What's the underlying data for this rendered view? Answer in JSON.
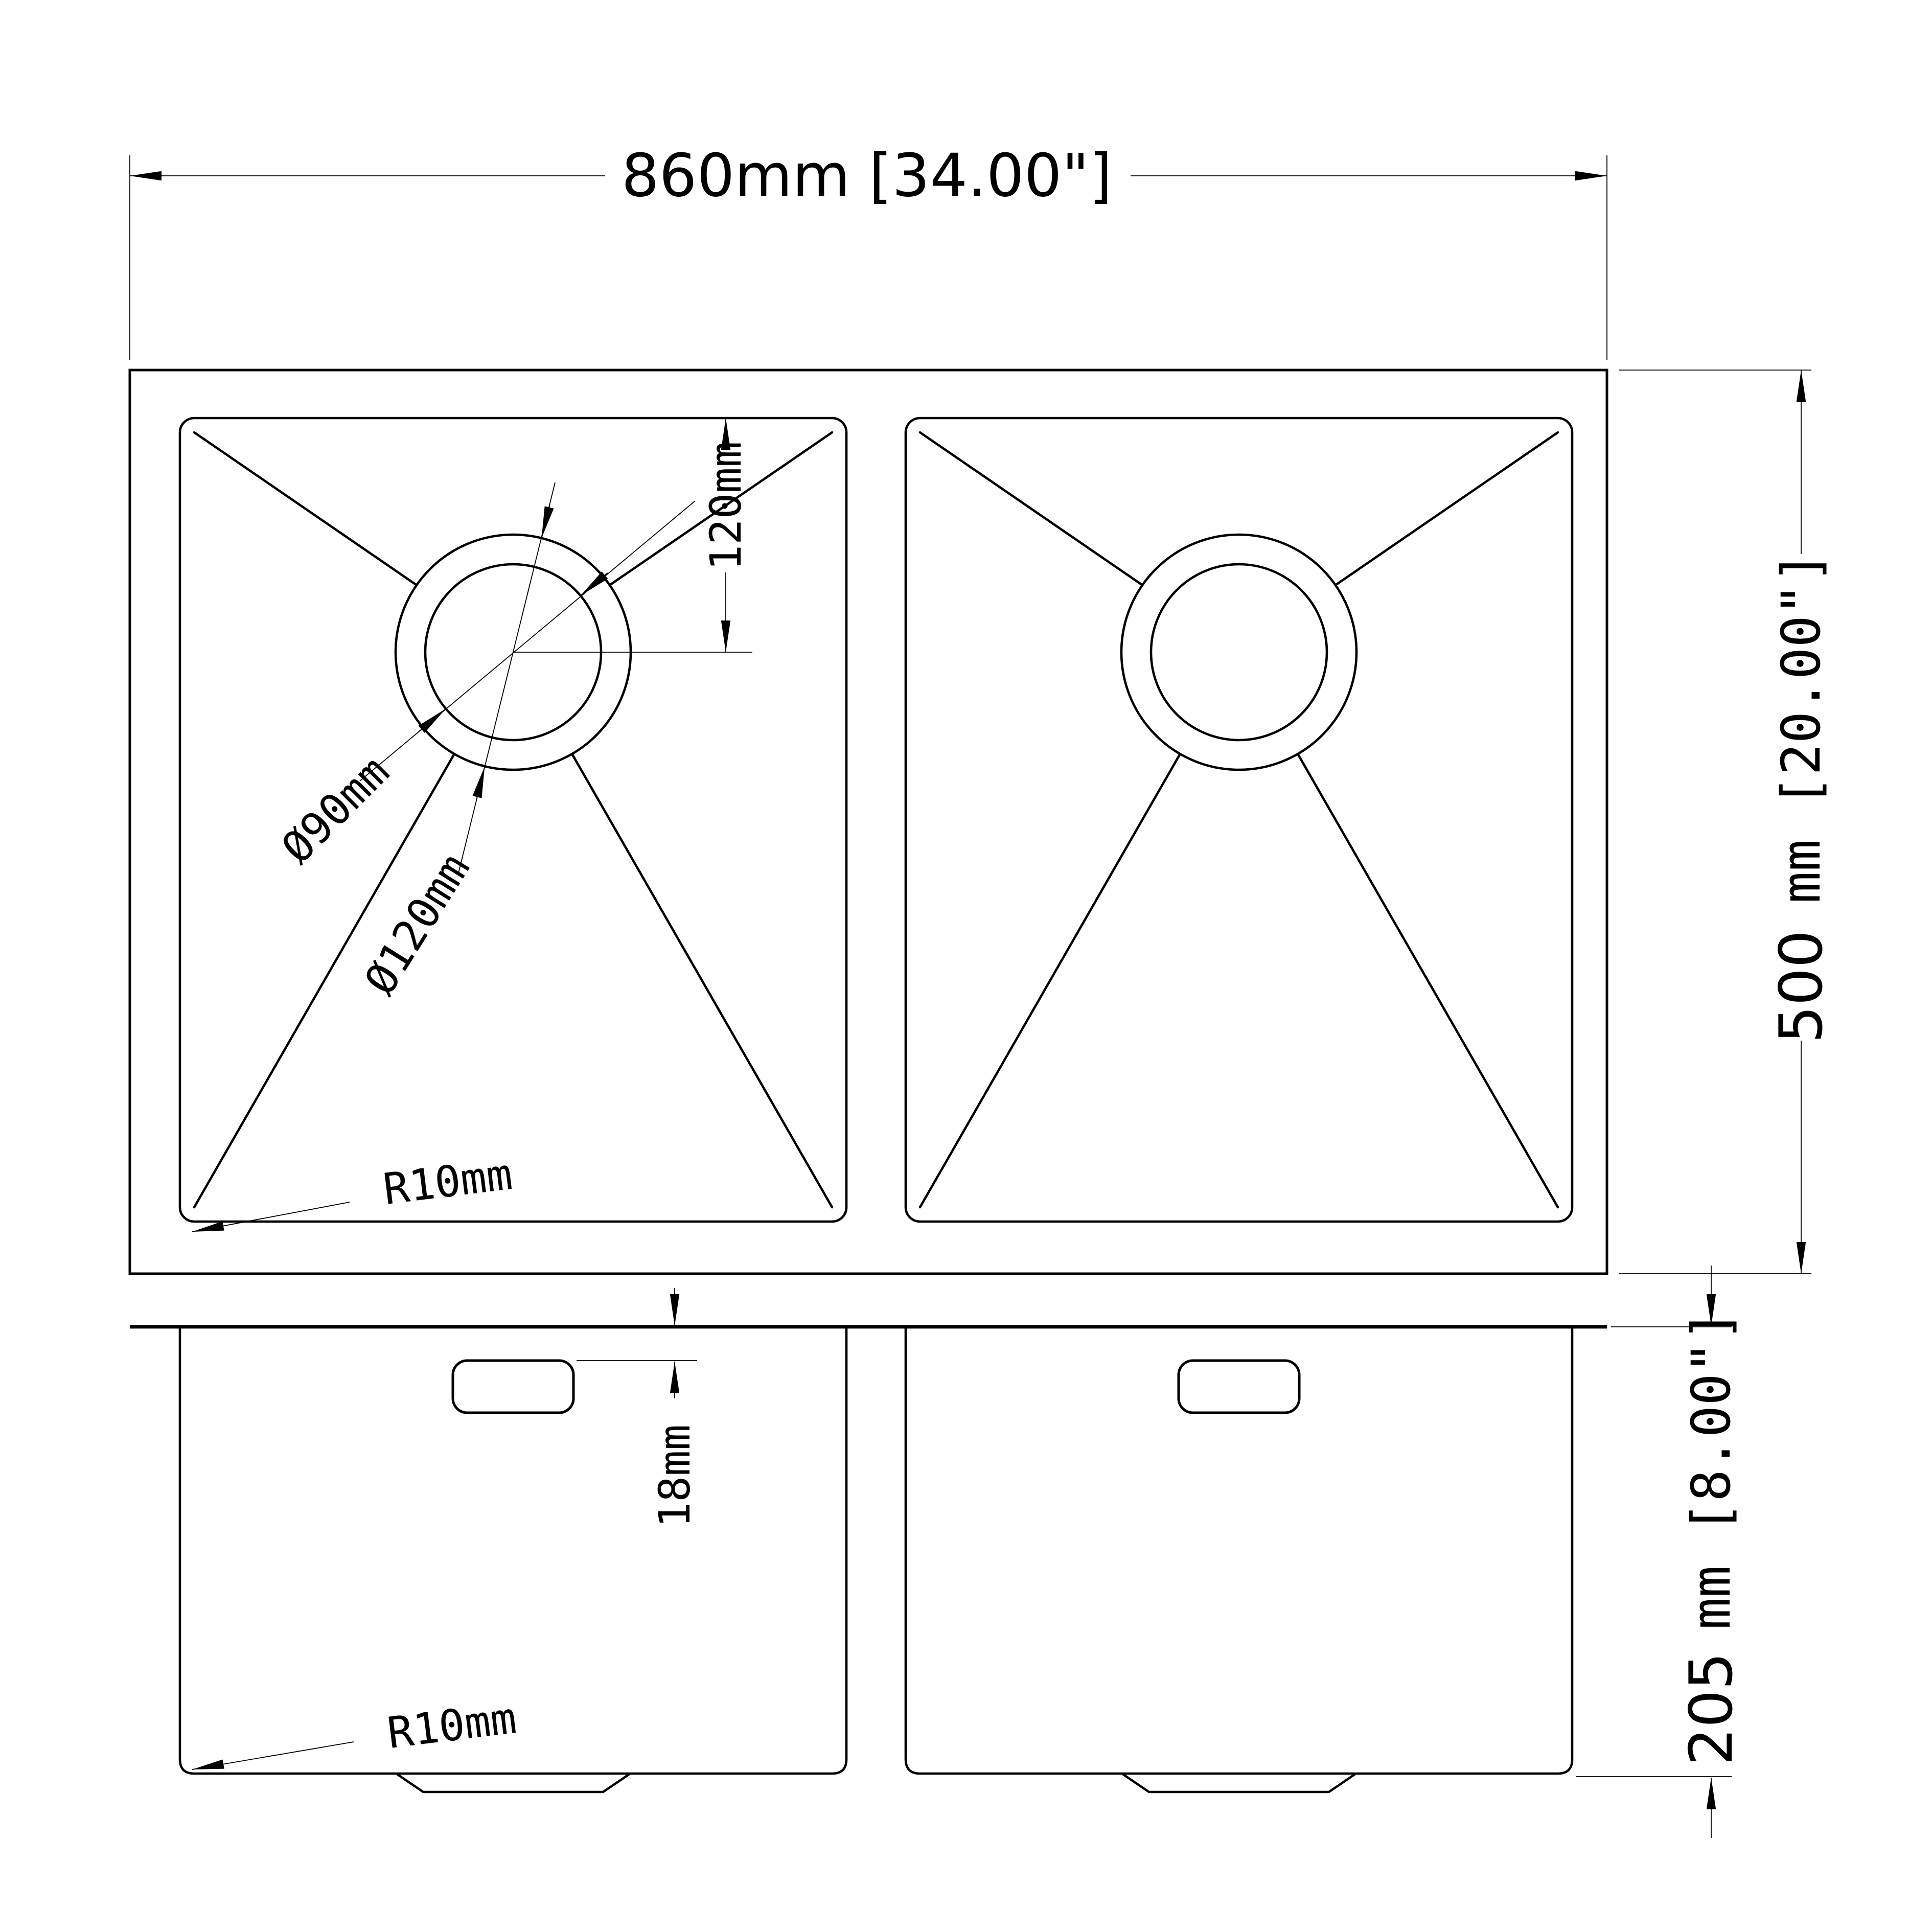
{
  "colors": {
    "ink": "#000000",
    "paper": "#ffffff"
  },
  "top_view": {
    "width_dim": "860mm [34.00\"]",
    "depth_dim_value": "500",
    "depth_dim_unit": "mm [20.00\"]",
    "drain_offset_dim": "120mm",
    "drain_inner_diameter": "Ø90mm",
    "drain_outer_diameter": "Ø120mm",
    "corner_radius": "R10mm"
  },
  "front_view": {
    "rim_height_dim": "18mm",
    "depth_dim_value": "205",
    "depth_dim_unit": "mm [8.00\"]",
    "corner_radius": "R10mm"
  }
}
